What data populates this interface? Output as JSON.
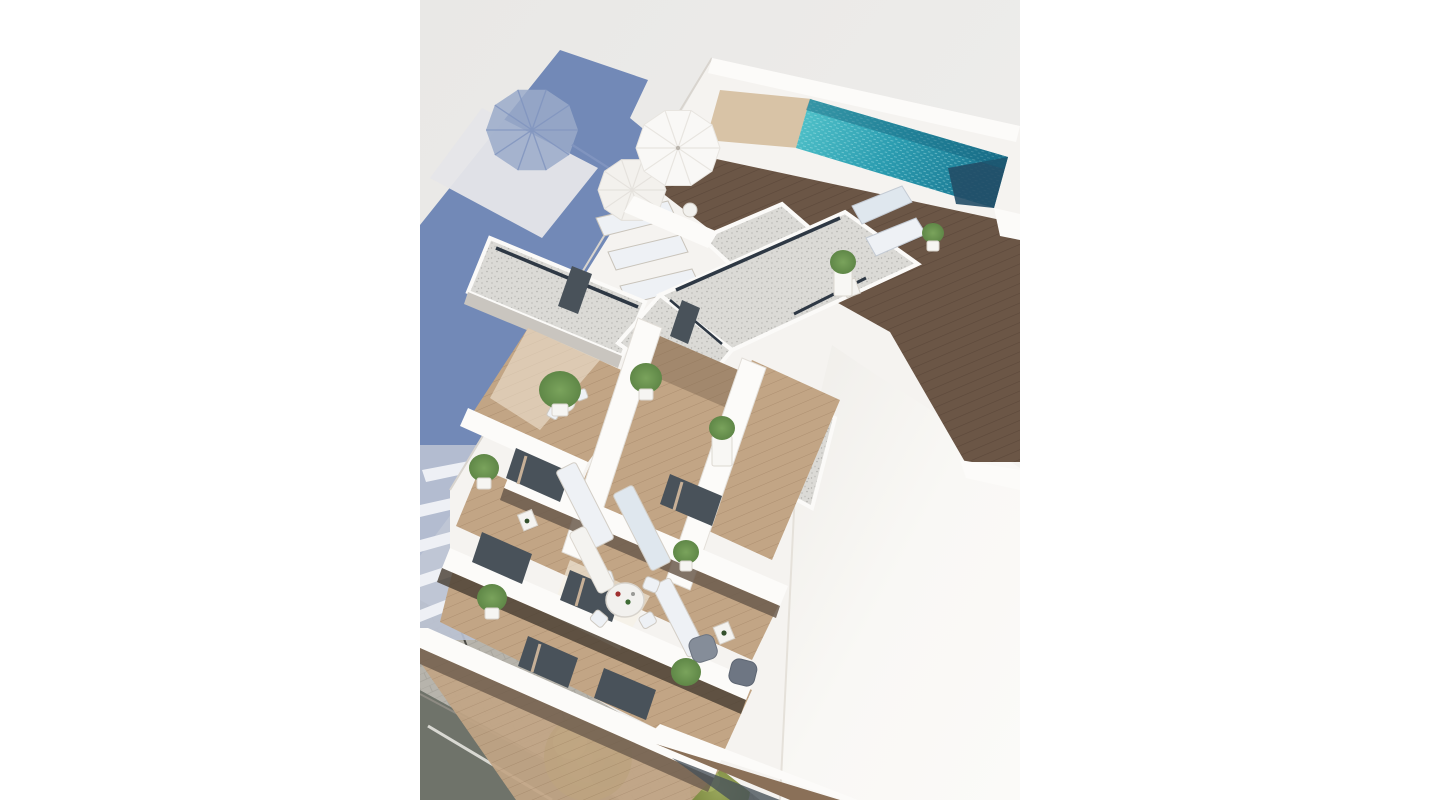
{
  "page": {
    "background": "#ffffff"
  },
  "image": {
    "type": "3d-architectural-render",
    "subject": "aerial-view-white-apartment-building-with-rooftop-pool-terraces-and-street",
    "left_margin_px": 420,
    "render_width_px": 600,
    "render_height_px": 800
  },
  "colors": {
    "render_bg": "#e9e8e6",
    "render_bg_light": "#f0efed",
    "shadow_blue": "#7289b7",
    "shadow_lit_patch": "#e6e6e9",
    "umbrella_shadow": "#9aaac9",
    "umbrella_shadow_line": "#8094bf",
    "neighbor_wall_shadow": "#bac2d3",
    "neighbor_slab_white": "#eef0f5",
    "building_white": "#f5f3f0",
    "parapet_white": "#fcfbf9",
    "wall_shade": "#dcd8d2",
    "se_face_white": "#f9f8f5",
    "se_face_deep": "#efede9",
    "deck_wood": "#6b5646",
    "deck_wood_line": "#5c483a",
    "terrace_wood": "#c2a585",
    "terrace_wood_line": "#ad8f70",
    "terrace_wood_shade": "#8a7058",
    "gravel": "#dbdad6",
    "gravel_dot_a": "#c4c3bf",
    "gravel_dot_b": "#b3b2ae",
    "pool_light": "#55c6cc",
    "pool_mid": "#2b9cb0",
    "pool_dark": "#1d7b95",
    "pool_steps": "#224d66",
    "pool_surround_tan": "#d8c3a6",
    "slot_dark": "#2e3844",
    "glass_dark": "#49525a",
    "curtain_beige": "#c7b097",
    "lounger_white": "#eef1f5",
    "lounger_blue": "#dfe7ee",
    "plant_green": "#5f8747",
    "plant_green_light": "#7aa35c",
    "tree_olive": "#9aa75c",
    "tree_olive_dark": "#7d8a42",
    "road_grey": "#6f736a",
    "road_line": "#d9d9d3",
    "sidewalk_grey": "#b7b4ac",
    "sidewalk_line": "#a6a39b",
    "armchair_grey": "#858d99",
    "armchair_grey_dark": "#6e7683",
    "table_white": "#f2f1ee",
    "under_slab_shadow": "#6b5b4c",
    "under_slab_deep": "#463c31"
  },
  "scene": {
    "objects": [
      "rooftop-pool",
      "pool-steps",
      "sun-umbrella",
      "sun-umbrella-second",
      "umbrella-cast-shadow",
      "building-cast-shadow",
      "rooftop-wood-deck",
      "sun-loungers",
      "gravel-roofs",
      "penthouse-terraces",
      "potted-plants",
      "round-dining-table",
      "terrace-chairs",
      "grey-armchairs",
      "balcony-rows",
      "glass-doors",
      "street-road",
      "sidewalk",
      "street-trees",
      "lamp-posts",
      "neighbor-building-in-shadow",
      "sunlit-side-wall"
    ]
  }
}
